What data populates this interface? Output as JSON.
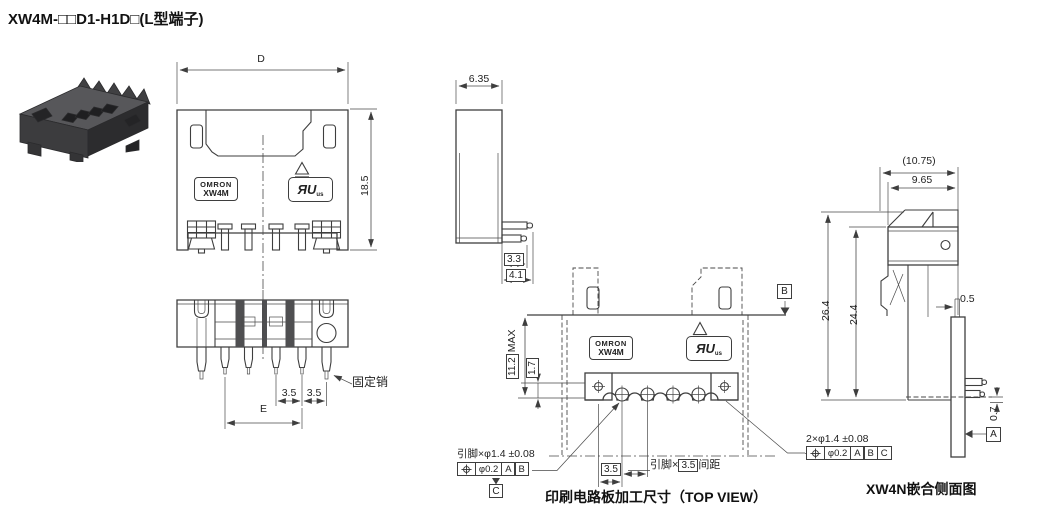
{
  "title": "XW4M-□□D1-H1D□(L型端子)",
  "brand_badge": {
    "brand": "OMRON",
    "model": "XW4M"
  },
  "ul_badge": {
    "mark": "ЯU",
    "suffix": "us"
  },
  "front_view": {
    "dim_width": "D",
    "dim_height": "18.5"
  },
  "bottom_view": {
    "dim_pitch_a": "3.5",
    "dim_pitch_b": "3.5",
    "dim_span": "E",
    "fixing_pin_label": "固定销"
  },
  "side_view": {
    "dim_width": "6.35",
    "dim_pin_short": "3.3",
    "dim_pin_long": "4.1"
  },
  "top_view": {
    "dim_height": "11.2",
    "dim_height_suffix": "MAX",
    "dim_offset": "1.7",
    "datum_b": "B",
    "datum_c": "C",
    "dim_hole_pitch": "3.5",
    "pitch_note_prefix": "引脚×",
    "pitch_note_value": "3.5",
    "pitch_note_suffix": "间距",
    "pin_hole_note": "引脚×φ1.4 ±0.08",
    "fcf": {
      "tolerance": "φ0.2",
      "datums": [
        "A",
        "B"
      ]
    },
    "caption": "印刷电路板加工尺寸（TOP VIEW）"
  },
  "mating_view": {
    "dim_overall": "(10.75)",
    "dim_inner": "9.65",
    "dim_total_height": "26.4",
    "dim_body_height": "24.4",
    "dim_tab": "0.5",
    "dim_pin_offset": "0.7",
    "datum_a": "A",
    "pin_hole_note": "2×φ1.4 ±0.08",
    "fcf": {
      "tolerance": "φ0.2",
      "datums": [
        "A",
        "B",
        "C"
      ]
    },
    "caption": "XW4N嵌合侧面图"
  }
}
